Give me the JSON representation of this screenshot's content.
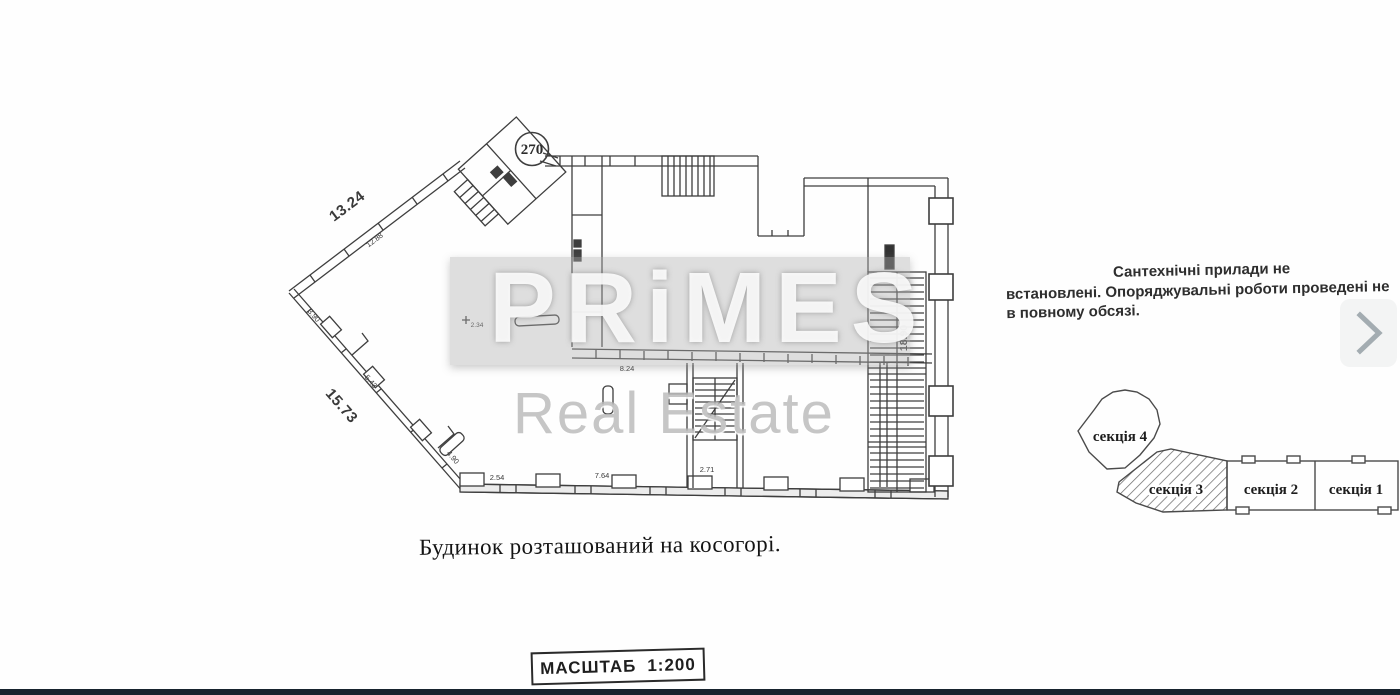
{
  "colors": {
    "ink": "#3a3a3a",
    "watermark_band": "#b0b0b0",
    "chevron": "#a3acb1",
    "bottom_bar": "#17232e"
  },
  "watermark": {
    "brand": "PRiMES",
    "subtitle": "Real Estate"
  },
  "plan": {
    "unit_number": "270",
    "dims": {
      "top_wall": "13.24",
      "top_wall_small": "12.88",
      "left_wall": "15.73",
      "left_seg_a": "3.90",
      "left_seg_b": "5.43",
      "left_seg_c": "4.90",
      "bottom_seg_a": "2.54",
      "bottom_seg_b": "7.64",
      "bottom_seg_c": "2.71",
      "interior_a": "8.24",
      "interior_b": "2.34",
      "stairwell": "18.90"
    }
  },
  "note": {
    "lines": [
      "Сантехнічні прилади не",
      "встановлені. Опоряджувальні роботи  проведені не",
      "в повному обсязі."
    ]
  },
  "sections": {
    "items": [
      {
        "label": "секція 4"
      },
      {
        "label": "секція 3"
      },
      {
        "label": "секція 2"
      },
      {
        "label": "секція 1"
      }
    ]
  },
  "caption": {
    "text": "Будинок розташований на косогорі."
  },
  "scale": {
    "label": "МАСШТАБ",
    "value": "1:200"
  }
}
